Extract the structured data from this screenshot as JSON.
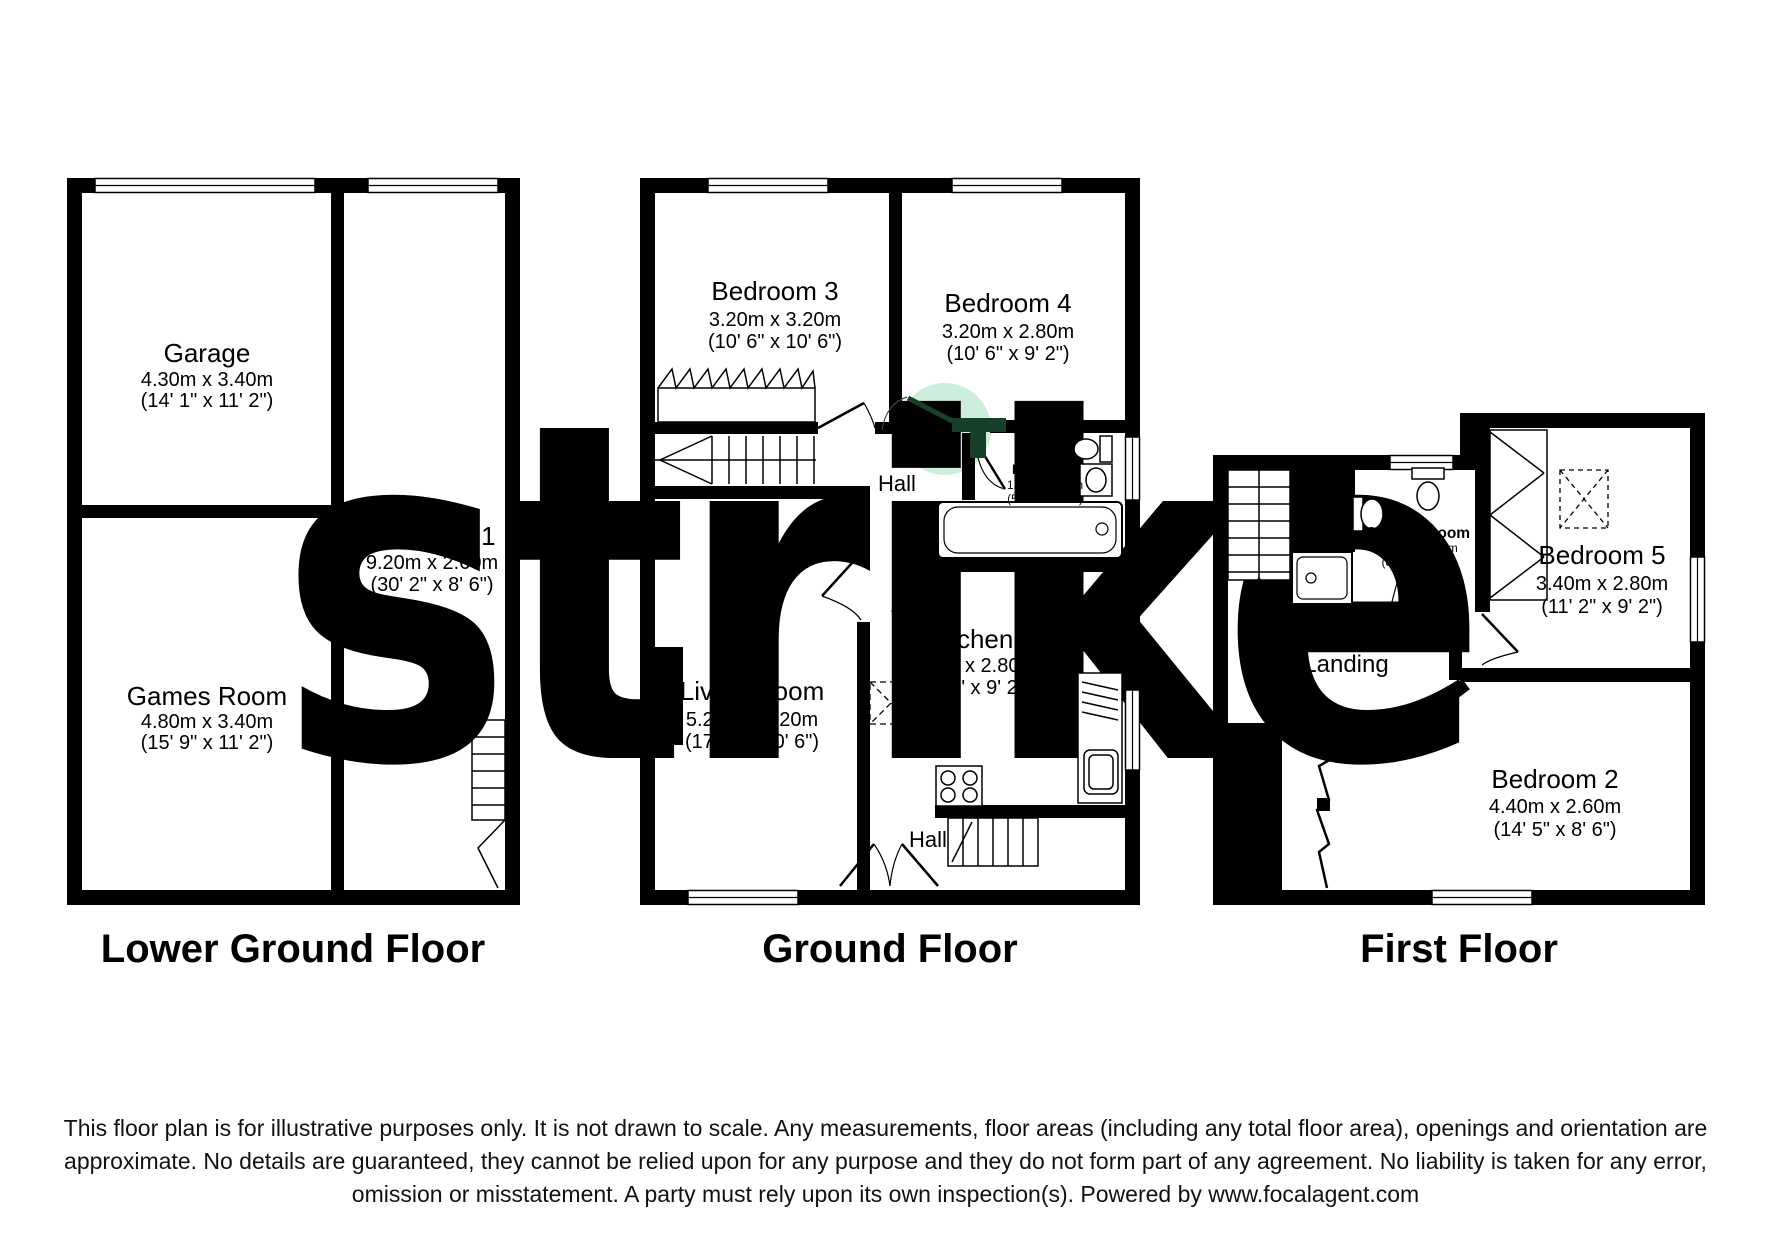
{
  "watermark": {
    "text": "strike",
    "color": "#cfcfcf"
  },
  "highlight": {
    "color": "#cdeedd",
    "door_color": "#16402a"
  },
  "floors": [
    {
      "label": "Lower Ground Floor",
      "rooms": [
        {
          "name": "Garage",
          "metric": "4.30m x 3.40m",
          "imperial": "(14' 1\" x 11' 2\")"
        },
        {
          "name": "Bedroom 1",
          "metric": "9.20m x 2.60m",
          "imperial": "(30' 2\" x 8' 6\")"
        },
        {
          "name": "Games Room",
          "metric": "4.80m x 3.40m",
          "imperial": "(15' 9\" x 11' 2\")"
        }
      ]
    },
    {
      "label": "Ground Floor",
      "rooms": [
        {
          "name": "Bedroom 3",
          "metric": "3.20m x 3.20m",
          "imperial": "(10' 6\" x 10' 6\")"
        },
        {
          "name": "Bedroom 4",
          "metric": "3.20m x 2.80m",
          "imperial": "(10' 6\" x 9' 2\")"
        },
        {
          "name": "Hall"
        },
        {
          "name": "Bathroom",
          "metric": "1.80m x 1.80m",
          "imperial": "(5' 11\" x 5' 11\")"
        },
        {
          "name": "Kitchen",
          "metric": "3.20m x 2.80m",
          "imperial": "(10' 6\" x 9' 2\")"
        },
        {
          "name": "Living Room",
          "metric": "5.20m x 3.20m",
          "imperial": "(17' 1\" x 10' 6\")"
        },
        {
          "name": "Hall"
        }
      ]
    },
    {
      "label": "First Floor",
      "rooms": [
        {
          "name": "Shower Room",
          "metric": "2.50m x 1.80m",
          "imperial": "(8' 2\" x 5' 11\")"
        },
        {
          "name": "Bedroom 5",
          "metric": "3.40m x 2.80m",
          "imperial": "(11' 2\" x 9' 2\")"
        },
        {
          "name": "Landing"
        },
        {
          "name": "Bedroom 2",
          "metric": "4.40m x 2.60m",
          "imperial": "(14' 5\" x 8' 6\")"
        }
      ]
    }
  ],
  "disclaimer": {
    "text": "This floor plan is for illustrative purposes only. It is not drawn to scale. Any measurements, floor areas (including any total floor area), openings and orientation are approximate. No details are guaranteed, they cannot be relied upon for any purpose and they do not form part of any agreement. No liability is taken for any error, omission or misstatement. A party must rely upon its own inspection(s). Powered by www.focalagent.com"
  }
}
